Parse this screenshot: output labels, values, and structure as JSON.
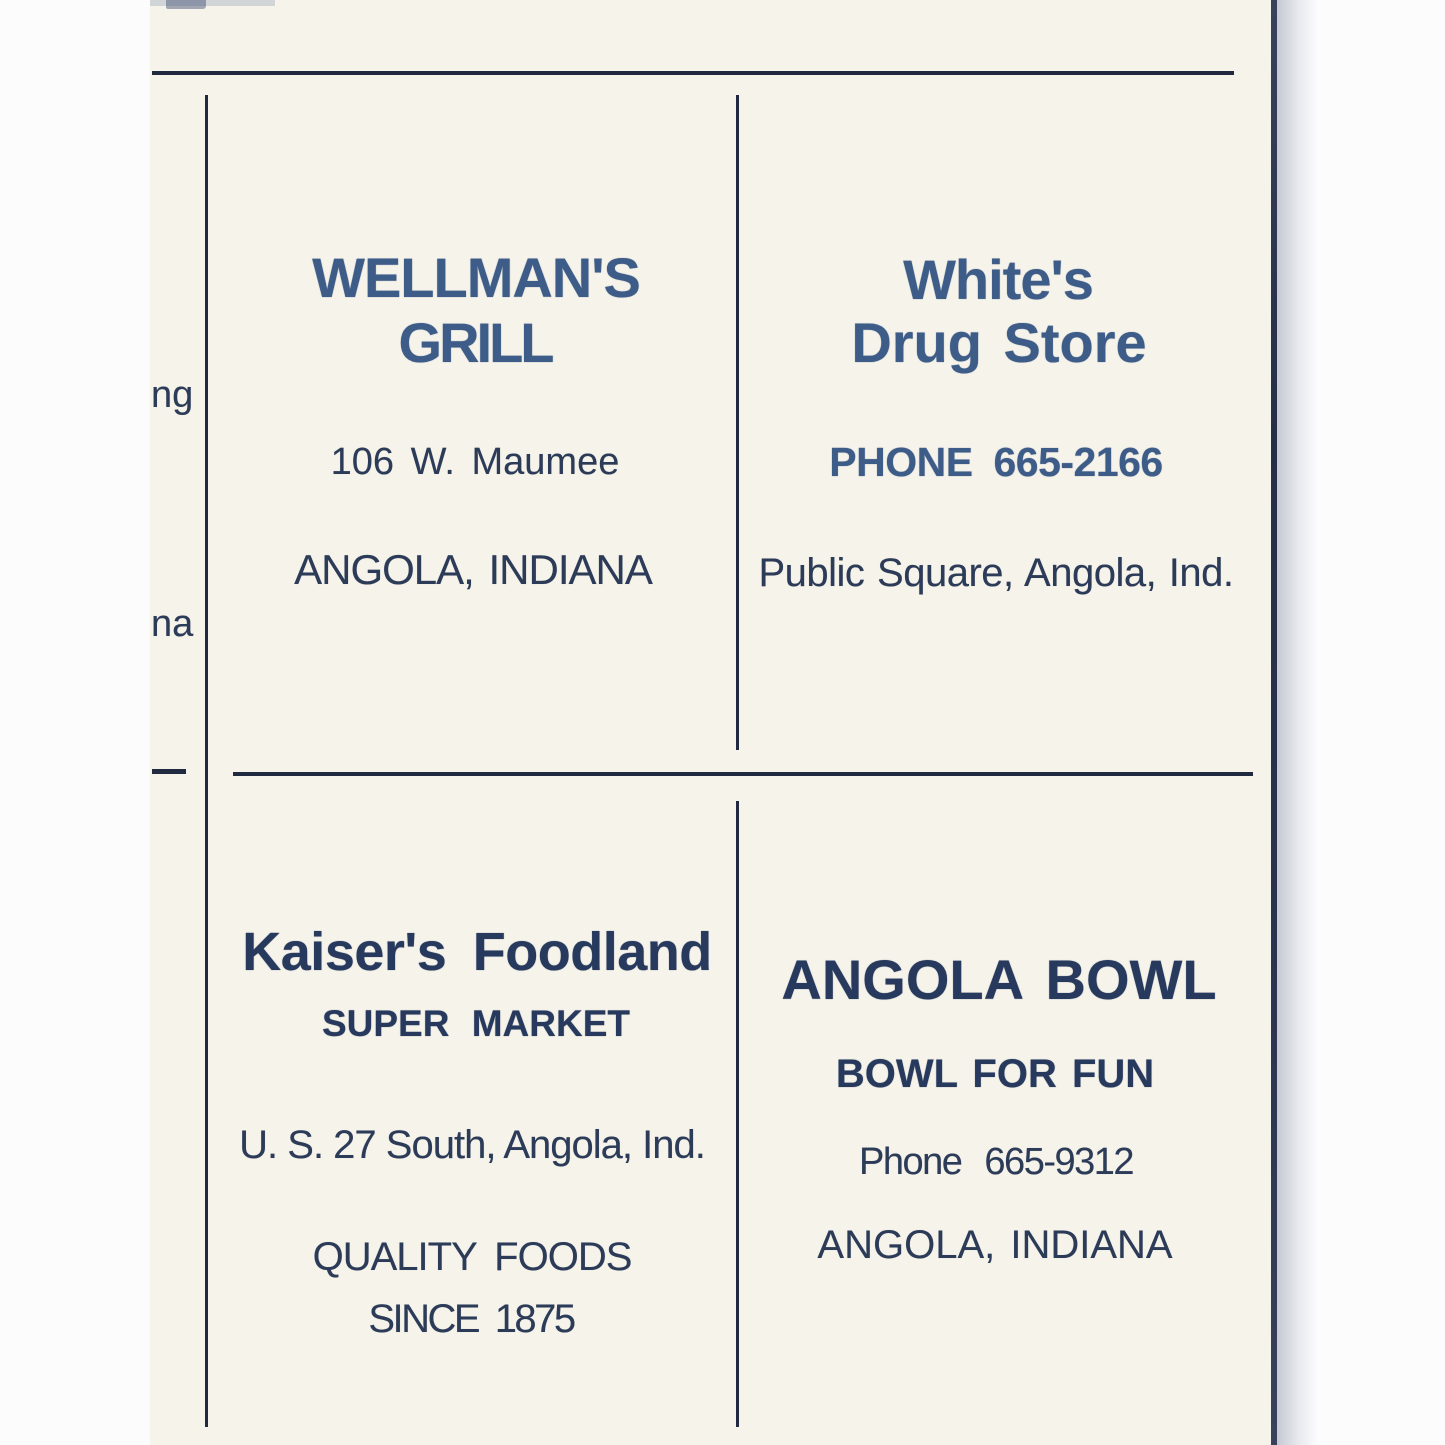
{
  "ads": {
    "wellmans_grill": {
      "name_line1": "WELLMAN'S",
      "name_line2": "GRILL",
      "address": "106 W. Maumee",
      "city": "ANGOLA, INDIANA"
    },
    "whites_drug_store": {
      "name_line1": "White's",
      "name_line2": "Drug Store",
      "phone": "PHONE 665-2166",
      "address": "Public Square, Angola, Ind."
    },
    "kaisers_foodland": {
      "name": "Kaiser's Foodland",
      "subtitle": "SUPER MARKET",
      "address": "U. S. 27 South, Angola, Ind.",
      "tagline_line1": "QUALITY FOODS",
      "tagline_line2": "SINCE 1875"
    },
    "angola_bowl": {
      "name": "ANGOLA BOWL",
      "tagline": "BOWL FOR FUN",
      "phone": "Phone 665-9312",
      "city": "ANGOLA, INDIANA"
    }
  },
  "edge_fragments": {
    "left_top": "ng",
    "left_bottom": "na"
  },
  "colors": {
    "paper": "#f6f3ea",
    "ink_body": "#2c3b58",
    "ink_stamped_blue": "#3e5c88",
    "ink_stamped_navy": "#27395d",
    "rule": "#20293f"
  }
}
